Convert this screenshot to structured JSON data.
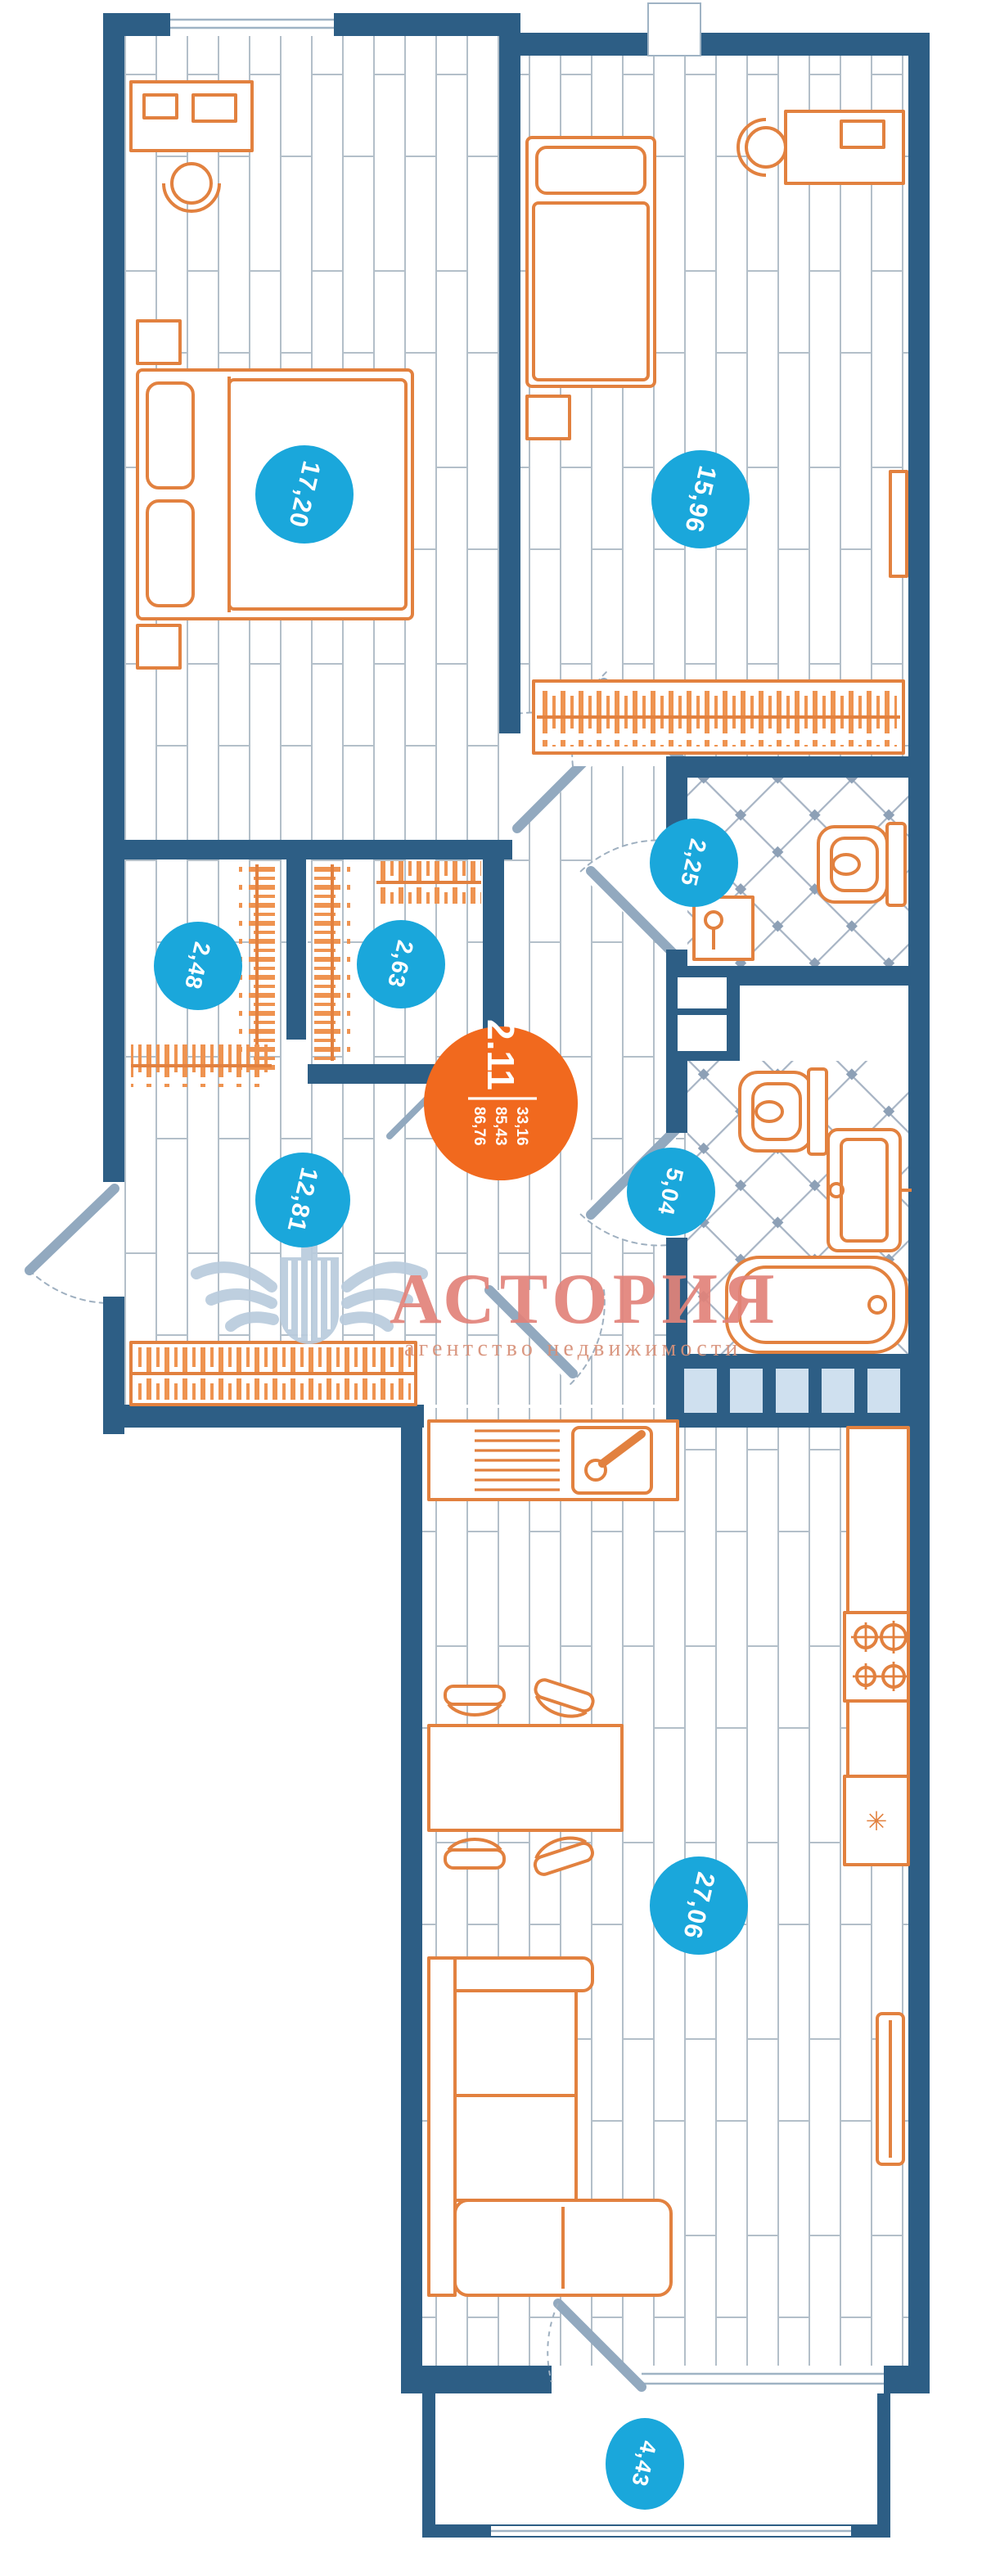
{
  "plan": {
    "type": "apartment-floor-plan",
    "badge": {
      "apartment_number": "2.11",
      "living_area": "33,16",
      "apartment_area": "85,43",
      "total_area": "86,76"
    },
    "rooms": [
      {
        "id": "bedroom-left",
        "area": "17,20"
      },
      {
        "id": "bedroom-right",
        "area": "15,96"
      },
      {
        "id": "wc-small",
        "area": "2,25"
      },
      {
        "id": "closet-left",
        "area": "2,48"
      },
      {
        "id": "closet-right",
        "area": "2,63"
      },
      {
        "id": "bathroom-large",
        "area": "5,04"
      },
      {
        "id": "hallway",
        "area": "12,81"
      },
      {
        "id": "kitchen-living",
        "area": "27,06"
      },
      {
        "id": "balcony",
        "area": "4,43"
      }
    ],
    "symbols": {
      "fridge": "✳"
    },
    "watermark": {
      "title": "АСТОРИЯ",
      "subtitle": "агентство недвижимости"
    },
    "colors": {
      "wall_navy": "#2d5e85",
      "furniture_orange": "#e2813f",
      "hatch_orange": "#ef9350",
      "label_cyan": "#1aa7db",
      "badge_orange": "#f1691e",
      "watermark_salmon": "#e2837a",
      "plank_line": "#b3bfc9"
    }
  }
}
